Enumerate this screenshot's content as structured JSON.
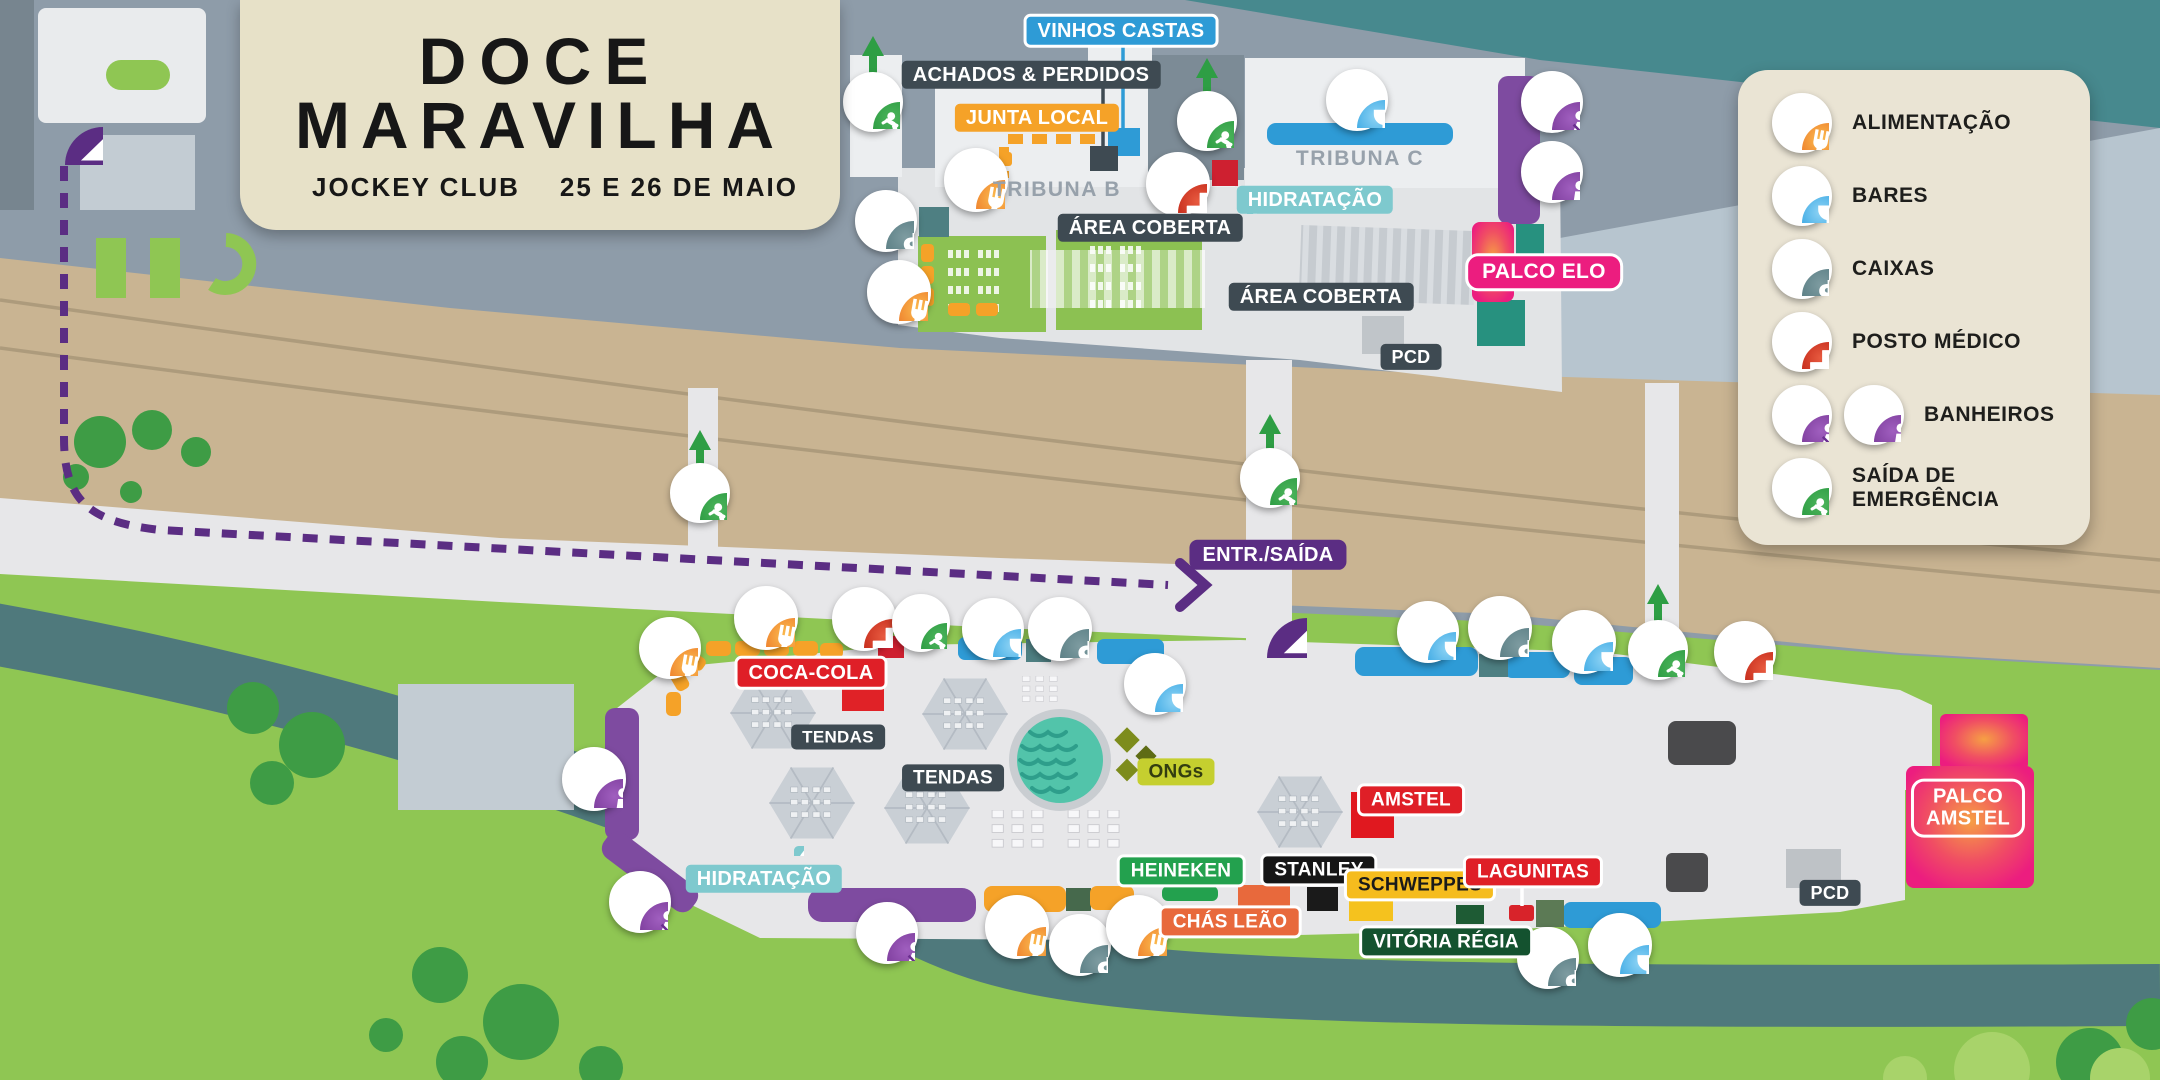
{
  "title_card": {
    "line1": "DOCE",
    "line2": "MARAVILHA",
    "venue": "JOCKEY CLUB",
    "dates": "25 E 26 DE MAIO"
  },
  "legend": {
    "items": [
      {
        "icon": "food-icon",
        "label": "ALIMENTAÇÃO"
      },
      {
        "icon": "bar-icon",
        "label": "BARES"
      },
      {
        "icon": "cash-icon",
        "label": "CAIXAS"
      },
      {
        "icon": "medical-icon",
        "label": "POSTO MÉDICO"
      },
      {
        "icon": "wc-female-icon,wc-male-icon",
        "label": "BANHEIROS"
      },
      {
        "icon": "emergency-exit-icon",
        "label": "SAÍDA DE EMERGÊNCIA"
      }
    ]
  },
  "map": {
    "labels": [
      {
        "id": "label-vinhos-castas",
        "t": "VINHOS CASTAS",
        "x": 1121,
        "y": 31,
        "c": "blue",
        "fs": 20
      },
      {
        "id": "label-achados-perdidos",
        "t": "ACHADOS & PERDIDOS",
        "x": 1031,
        "y": 75,
        "c": "dark",
        "fs": 20
      },
      {
        "id": "label-junta-local",
        "t": "JUNTA LOCAL",
        "x": 1037,
        "y": 118,
        "c": "orange",
        "fs": 20
      },
      {
        "id": "label-tribuna-b",
        "t": "TRIBUNA B",
        "x": 1057,
        "y": 190,
        "c": "plain",
        "fs": 21
      },
      {
        "id": "label-tribuna-c",
        "t": "TRIBUNA C",
        "x": 1360,
        "y": 159,
        "c": "plain",
        "fs": 21
      },
      {
        "id": "label-area-coberta-1",
        "t": "ÁREA COBERTA",
        "x": 1150,
        "y": 228,
        "c": "dark",
        "fs": 20
      },
      {
        "id": "label-area-coberta-2",
        "t": "ÁREA COBERTA",
        "x": 1321,
        "y": 297,
        "c": "dark",
        "fs": 20
      },
      {
        "id": "label-hidratacao-1",
        "t": "HIDRATAÇÃO",
        "x": 1315,
        "y": 200,
        "c": "teal",
        "fs": 20
      },
      {
        "id": "label-palco-elo",
        "t": "PALCO ELO",
        "x": 1544,
        "y": 272,
        "c": "pinkpill",
        "fs": 21
      },
      {
        "id": "label-pcd-1",
        "t": "PCD",
        "x": 1411,
        "y": 357,
        "c": "dark",
        "fs": 18
      },
      {
        "id": "label-entr-saida",
        "t": "ENTR./SAÍDA",
        "x": 1268,
        "y": 555,
        "c": "purple",
        "fs": 20
      },
      {
        "id": "label-coca-cola",
        "t": "COCA-COLA",
        "x": 811,
        "y": 673,
        "c": "red",
        "fs": 20
      },
      {
        "id": "label-tendas-1",
        "t": "TENDAS",
        "x": 838,
        "y": 737,
        "c": "dark",
        "fs": 17
      },
      {
        "id": "label-tendas-2",
        "t": "TENDAS",
        "x": 953,
        "y": 778,
        "c": "dark",
        "fs": 19
      },
      {
        "id": "label-hidratacao-2",
        "t": "HIDRATAÇÃO",
        "x": 764,
        "y": 879,
        "c": "teal",
        "fs": 20
      },
      {
        "id": "label-ongs",
        "t": "ONGs",
        "x": 1176,
        "y": 772,
        "c": "ongs",
        "fs": 19
      },
      {
        "id": "label-amstel",
        "t": "AMSTEL",
        "x": 1411,
        "y": 800,
        "c": "red",
        "fs": 19
      },
      {
        "id": "label-heineken",
        "t": "HEINEKEN",
        "x": 1181,
        "y": 871,
        "c": "green",
        "fs": 19
      },
      {
        "id": "label-stanley",
        "t": "STANLEY",
        "x": 1319,
        "y": 870,
        "c": "black",
        "fs": 19
      },
      {
        "id": "label-schweppes",
        "t": "SCHWEPPES",
        "x": 1420,
        "y": 885,
        "c": "yellow",
        "fs": 19
      },
      {
        "id": "label-lagunitas",
        "t": "LAGUNITAS",
        "x": 1533,
        "y": 872,
        "c": "red",
        "fs": 19
      },
      {
        "id": "label-chas-leao",
        "t": "CHÁS LEÃO",
        "x": 1230,
        "y": 922,
        "c": "chas",
        "fs": 19
      },
      {
        "id": "label-vitoria-regia",
        "t": "VITÓRIA RÉGIA",
        "x": 1446,
        "y": 942,
        "c": "darkgreen",
        "fs": 19
      },
      {
        "id": "label-pcd-2",
        "t": "PCD",
        "x": 1830,
        "y": 893,
        "c": "dark",
        "fs": 18
      },
      {
        "id": "label-palco-amstel",
        "t": "PALCO\nAMSTEL",
        "x": 1968,
        "y": 808,
        "c": "pinkoutline",
        "fs": 20
      }
    ],
    "markers": [
      {
        "t": "entrance",
        "x": 65,
        "y": 127,
        "d": 76
      },
      {
        "t": "exit",
        "x": 873,
        "y": 102,
        "d": 54
      },
      {
        "t": "exit",
        "x": 1207,
        "y": 121,
        "d": 54
      },
      {
        "t": "food",
        "x": 976,
        "y": 180,
        "d": 58
      },
      {
        "t": "food",
        "x": 899,
        "y": 292,
        "d": 58
      },
      {
        "t": "cash",
        "x": 886,
        "y": 221,
        "d": 56
      },
      {
        "t": "medical",
        "x": 1178,
        "y": 184,
        "d": 58
      },
      {
        "t": "bar",
        "x": 1357,
        "y": 100,
        "d": 56
      },
      {
        "t": "wc-f",
        "x": 1552,
        "y": 102,
        "d": 56
      },
      {
        "t": "wc-m",
        "x": 1552,
        "y": 172,
        "d": 56
      },
      {
        "t": "drop",
        "x": 1247,
        "y": 204,
        "d": 20
      },
      {
        "t": "exit",
        "x": 700,
        "y": 493,
        "d": 54
      },
      {
        "t": "exit",
        "x": 1270,
        "y": 478,
        "d": 54
      },
      {
        "t": "entrance",
        "x": 1267,
        "y": 618,
        "d": 80
      },
      {
        "t": "food",
        "x": 670,
        "y": 648,
        "d": 56
      },
      {
        "t": "food",
        "x": 766,
        "y": 618,
        "d": 58
      },
      {
        "t": "medical",
        "x": 864,
        "y": 619,
        "d": 58
      },
      {
        "t": "exit",
        "x": 921,
        "y": 623,
        "d": 52
      },
      {
        "t": "bar",
        "x": 993,
        "y": 629,
        "d": 56
      },
      {
        "t": "cash",
        "x": 1060,
        "y": 629,
        "d": 58
      },
      {
        "t": "bar",
        "x": 1155,
        "y": 684,
        "d": 56
      },
      {
        "t": "bar",
        "x": 1428,
        "y": 632,
        "d": 56
      },
      {
        "t": "cash",
        "x": 1500,
        "y": 628,
        "d": 58
      },
      {
        "t": "bar",
        "x": 1584,
        "y": 642,
        "d": 58
      },
      {
        "t": "exit",
        "x": 1658,
        "y": 650,
        "d": 54
      },
      {
        "t": "medical",
        "x": 1745,
        "y": 652,
        "d": 56
      },
      {
        "t": "wc-m",
        "x": 594,
        "y": 779,
        "d": 58
      },
      {
        "t": "wc-f",
        "x": 640,
        "y": 902,
        "d": 56
      },
      {
        "t": "wc-f",
        "x": 887,
        "y": 933,
        "d": 56
      },
      {
        "t": "drop",
        "x": 794,
        "y": 846,
        "d": 20
      },
      {
        "t": "food",
        "x": 1017,
        "y": 927,
        "d": 58
      },
      {
        "t": "cash",
        "x": 1080,
        "y": 945,
        "d": 56
      },
      {
        "t": "food",
        "x": 1138,
        "y": 927,
        "d": 58
      },
      {
        "t": "cash",
        "x": 1548,
        "y": 958,
        "d": 56
      },
      {
        "t": "bar",
        "x": 1620,
        "y": 945,
        "d": 58
      }
    ]
  },
  "colors": {
    "alimentacao": "#E8622B",
    "bares": "#1E8FD4",
    "caixas": "#5E8187",
    "posto_medico": "#C42A1A",
    "banheiros": "#7D3D9C",
    "saida_emergencia": "#2C9B42",
    "entrada": "#5B2D83",
    "stage_pink": "#EC1D7F",
    "grass": "#8FC653",
    "track": "#C9B492",
    "water": "#4F797C",
    "card_beige": "#E7E1C8",
    "label_dark": "#3E4A52"
  }
}
